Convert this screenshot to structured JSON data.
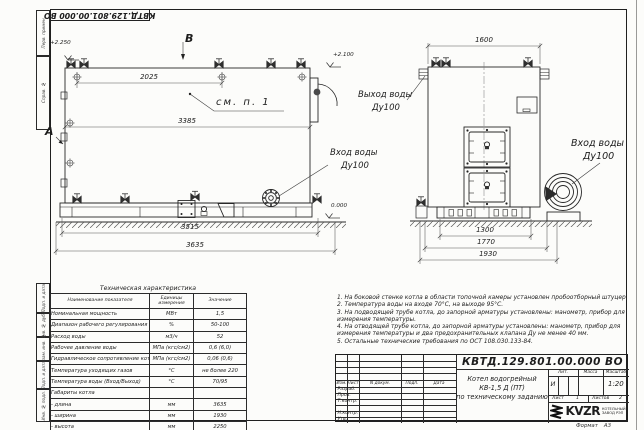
{
  "stamp": {
    "doc_number_top": "КВТД.129.801.00.000 ВО"
  },
  "frame": {
    "margin_labels": [
      "Перв. примен.",
      "Справ. №",
      "Подп. и дата",
      "Инв. № дубл.",
      "Взам. инв. №",
      "Подп. и дата",
      "Инв. № подл."
    ],
    "format_label": "Формат",
    "format_value": "А3"
  },
  "side_view": {
    "view_letter_top": "В",
    "view_letter_left": "А",
    "elev_top_left": "+2.250",
    "elev_top_right": "+2.100",
    "elev_zero": "0.000",
    "callout": "см. п. 1",
    "dim_top": "2025",
    "dim_shell": "3385",
    "dim_base": "3515",
    "dim_total": "3635",
    "inlet_label": "Вход воды",
    "inlet_dn": "Ду100"
  },
  "front_view": {
    "dim_top": "1600",
    "dim_base": "1300",
    "dim_mid": "1770",
    "dim_total": "1930",
    "outlet_label": "Выход воды",
    "outlet_dn": "Ду100",
    "inlet_label": "Вход воды",
    "inlet_dn": "Ду100"
  },
  "tech_table": {
    "title": "Техническая характеристика",
    "headers": [
      "Наименование показателя",
      "Единицы измерения",
      "Значение"
    ],
    "rows": [
      {
        "name": "Номинальная мощность",
        "unit": "МВт",
        "value": "1,5"
      },
      {
        "name": "Диапазон рабочего регулирования",
        "unit": "%",
        "value": "50-100"
      },
      {
        "name": "Расход воды",
        "unit": "м3/ч",
        "value": "52"
      },
      {
        "name": "Рабочее давление воды",
        "unit": "МПа (кгс/см2)",
        "value": "0,6 (6,0)"
      },
      {
        "name": "Гидравлическое сопротивление котла",
        "unit": "МПа (кгс/см2)",
        "value": "0,06 (0,6)"
      },
      {
        "name": "Температура уходящих газов",
        "unit": "°С",
        "value": "не более 220"
      },
      {
        "name": "Температура воды (Вход/Выход)",
        "unit": "°С",
        "value": "70/95"
      },
      {
        "name": "Габариты котла",
        "unit": "",
        "value": ""
      },
      {
        "name": "- длина",
        "unit": "мм",
        "value": "3635"
      },
      {
        "name": "- ширина",
        "unit": "мм",
        "value": "1930"
      },
      {
        "name": "- высота",
        "unit": "мм",
        "value": "2250"
      }
    ]
  },
  "notes": [
    "1.  На боковой стенке котла в области топочной камеры установлен пробоотборный штуцер",
    "2.  Температура воды на входе 70°С, на выходе 95°С.",
    "3.  На подводящей трубе котла, до запорной арматуры установлены: манометр, прибор для",
    "измерения температуры.",
    "4.  На отводящей трубе котла, до запорной арматуры установлены: манометр, прибор для",
    "измерения температуры и два предохранительных клапана Ду не менее 40 мм.",
    "5.  Остальные технические требования по ОСТ 108.030.133-84."
  ],
  "title_block": {
    "doc_number": "КВТД.129.801.00.000 ВО",
    "rev_headers": [
      "Изм.",
      "Лист",
      "N докум.",
      "Подп.",
      "Дата"
    ],
    "roles": [
      "Разраб.",
      "Пров.",
      "Т.контр.",
      "",
      "Н.контр.",
      "Утв."
    ],
    "name_line1": "Котел водогрейный",
    "name_line2": "КВ-1,5 Д (ПТ)",
    "name_line3": "по техническому заданию",
    "lit_header": "Лит.",
    "mass_header": "Масса",
    "scale_header": "Масштаб",
    "lit_value": "И",
    "scale_value": "1:20",
    "sheet_label": "Лист",
    "sheet_value": "1",
    "sheets_label": "Листов",
    "sheets_value": "2",
    "logo_text": "KVZR",
    "logo_sub1": "КОТЕЛЬНЫЙ",
    "logo_sub2": "ЗАВОД РЭП"
  }
}
